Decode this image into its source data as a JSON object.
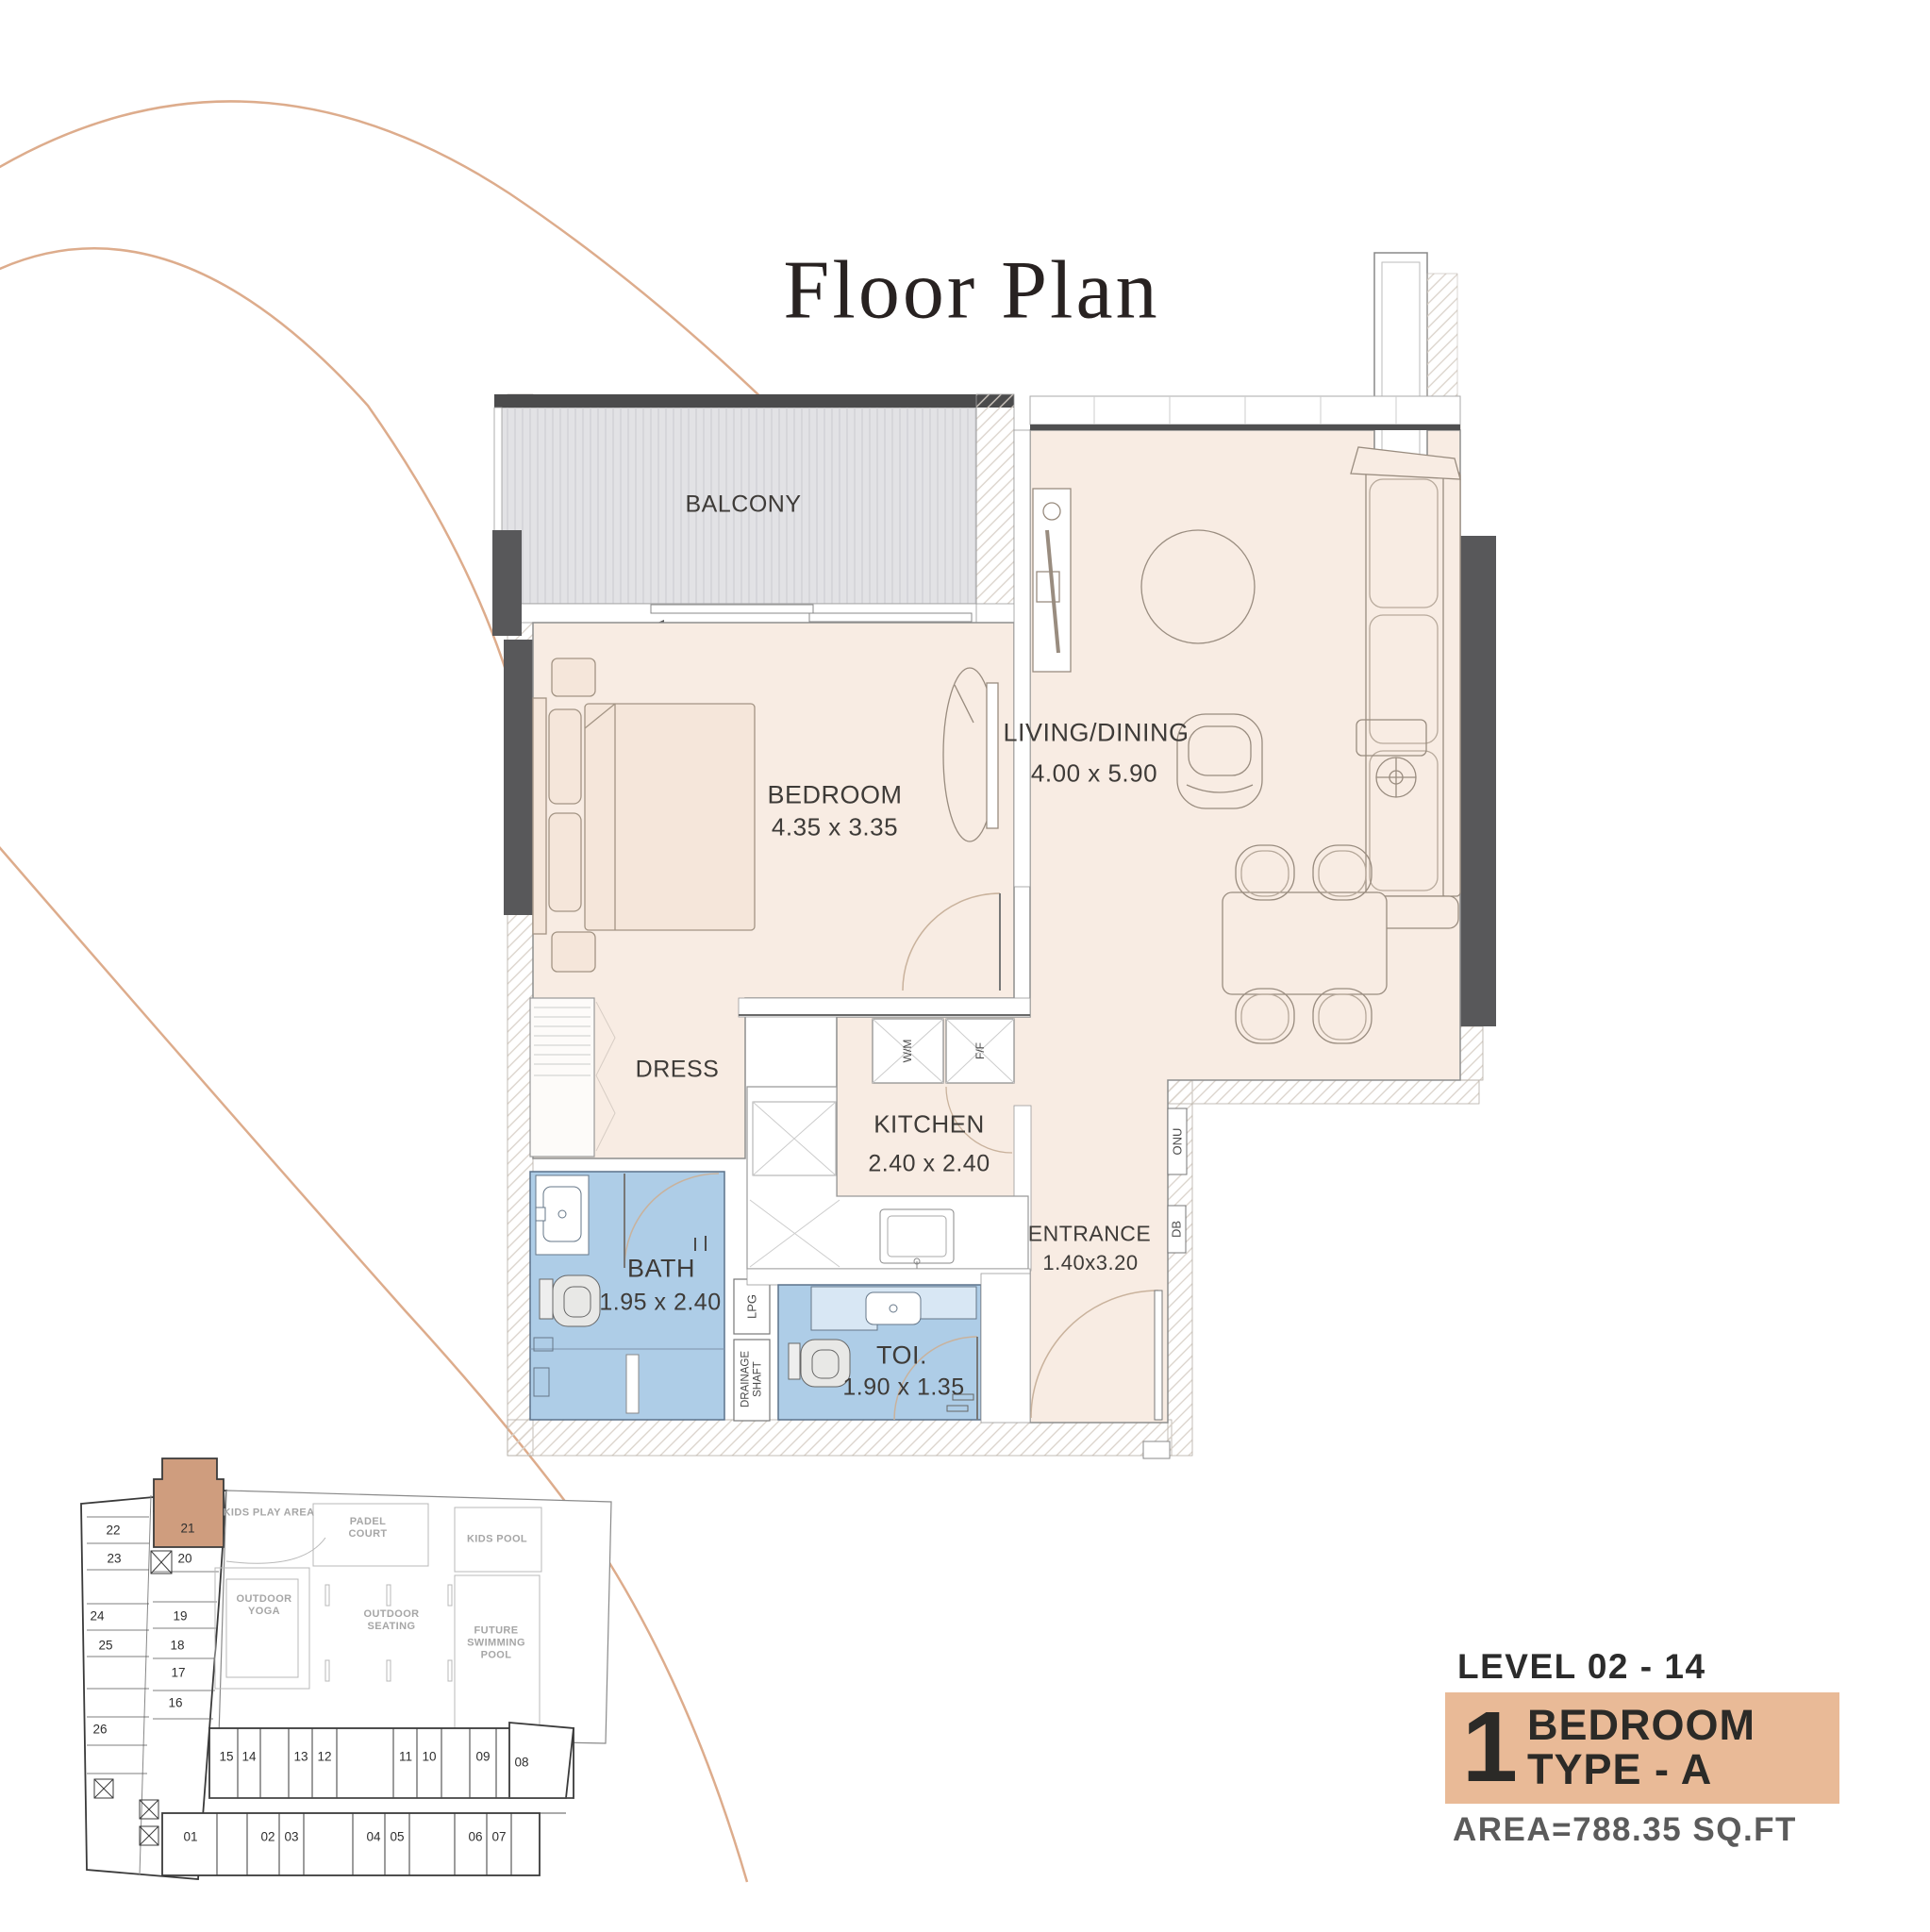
{
  "title": "Floor Plan",
  "plan": {
    "rooms": {
      "balcony": {
        "label": "BALCONY"
      },
      "bedroom": {
        "label": "BEDROOM",
        "dims": "4.35 x 3.35"
      },
      "living": {
        "label": "LIVING/DINING",
        "dims": "4.00 x 5.90"
      },
      "kitchen": {
        "label": "KITCHEN",
        "dims": "2.40 x 2.40"
      },
      "dress": {
        "label": "DRESS"
      },
      "bath": {
        "label": "BATH",
        "dims": "1.95 x 2.40"
      },
      "toilet": {
        "label": "TOI.",
        "dims": "1.90 x 1.35"
      },
      "entrance": {
        "label": "ENTRANCE",
        "dims": "1.40x3.20"
      }
    },
    "fixtures": {
      "wm": "W/M",
      "ff": "F/F",
      "lpg": "LPG",
      "drainage": "DRAINAGE SHAFT",
      "onu": "ONU",
      "db": "DB"
    }
  },
  "key_plan": {
    "highlighted_unit": "21",
    "amenities": {
      "kids_play": "KIDS PLAY AREA",
      "padel": "PADEL COURT",
      "kids_pool": "KIDS POOL",
      "yoga": "OUTDOOR YOGA",
      "seating": "OUTDOOR SEATING",
      "future_pool": "FUTURE SWIMMING POOL"
    },
    "units_left": [
      "22",
      "23",
      "24",
      "25",
      "26"
    ],
    "units_mid": [
      "21",
      "20",
      "19",
      "18",
      "17",
      "16"
    ],
    "units_row1": [
      "15",
      "14",
      "13",
      "12",
      "11",
      "10",
      "09",
      "08"
    ],
    "units_row2": [
      "01",
      "02",
      "03",
      "04",
      "05",
      "06",
      "07"
    ]
  },
  "info": {
    "level": "LEVEL 02 - 14",
    "unit_number": "1",
    "type_line1": "BEDROOM",
    "type_line2": "TYPE - A",
    "area": "AREA=788.35 SQ.FT"
  },
  "colors": {
    "floor": "#f8ece3",
    "balcony_gray": "#e2e2e5",
    "wet_blue": "#aecde7",
    "wall_dark": "#58585a",
    "accent_tan": "#e9ba97",
    "keyplan_highlight": "#cf9d7e",
    "arc_line": "#ddac8c"
  }
}
